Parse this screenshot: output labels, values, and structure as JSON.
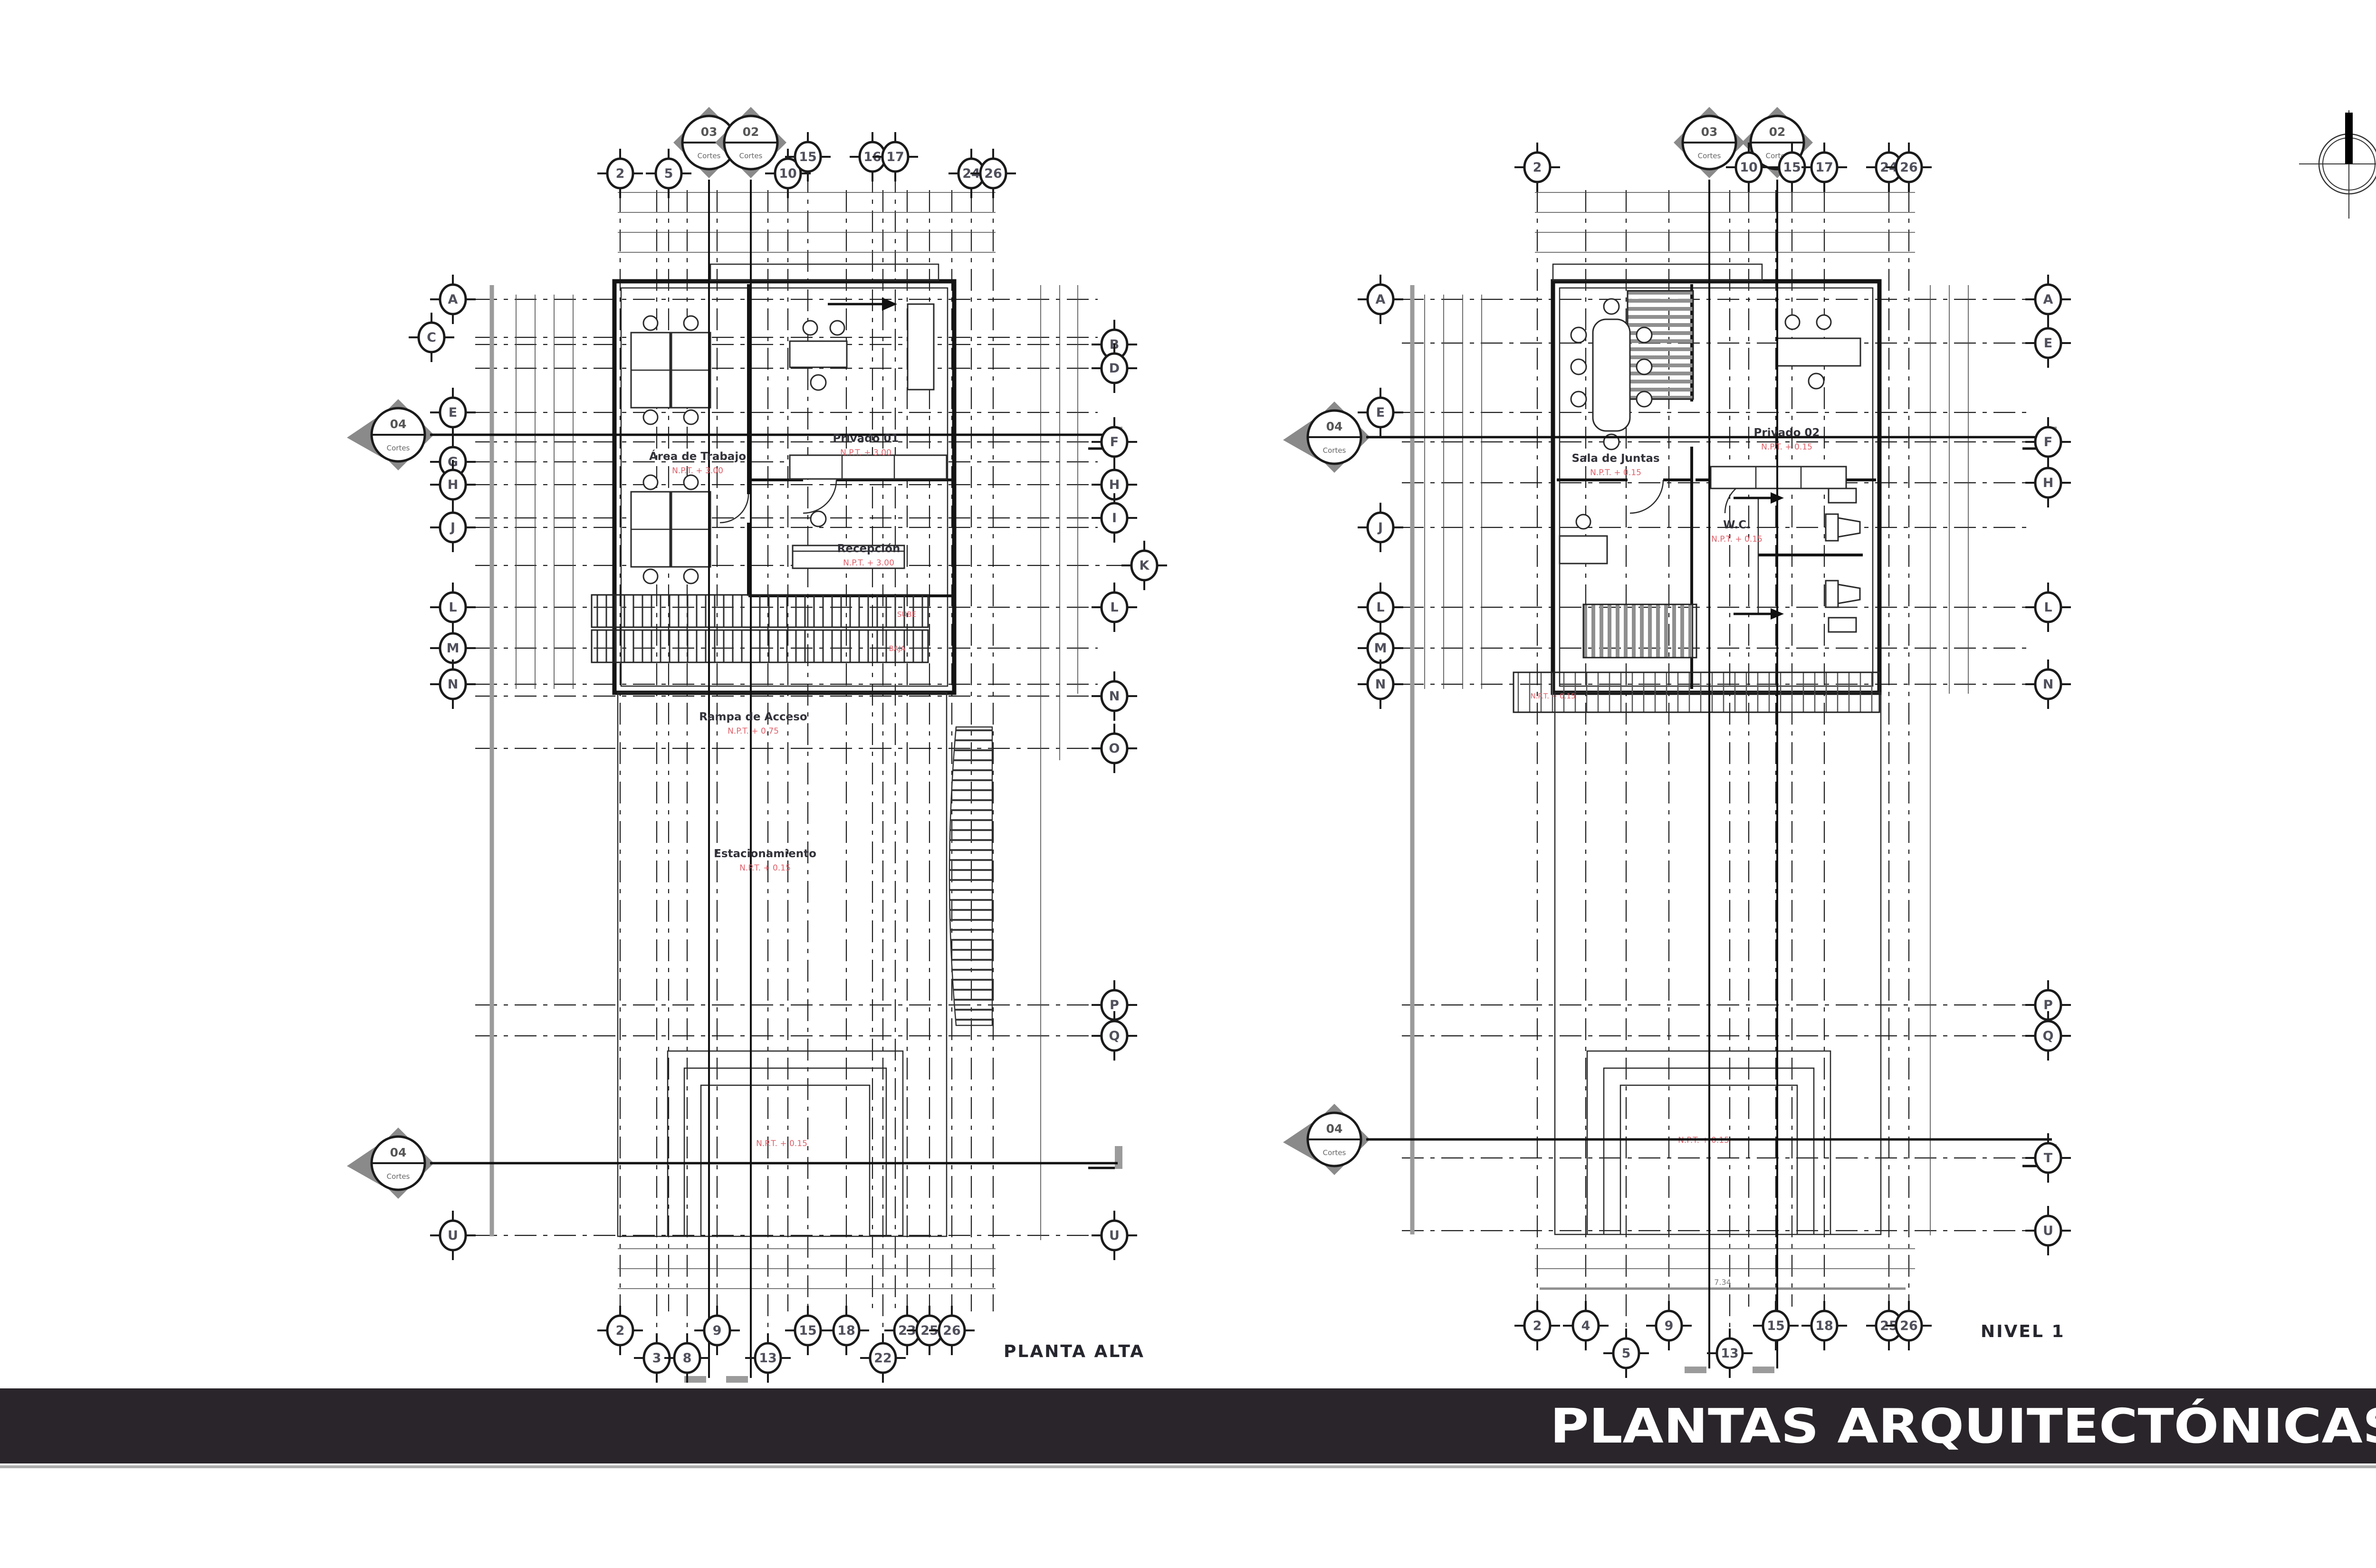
{
  "sheet": {
    "background": "#ffffff"
  },
  "banner": {
    "title": "PLANTAS ARQUITECTÓNICAS",
    "bg": "#29252a",
    "fg": "#ffffff",
    "underline": "#adadad"
  },
  "compass": {
    "meaning": "north-indicator"
  },
  "plans": [
    {
      "title": "PLANTA ALTA",
      "grid_top": [
        "2",
        "5",
        "10",
        "15",
        "16",
        "17",
        "24",
        "26"
      ],
      "grid_bottom": [
        "2",
        "3",
        "8",
        "9",
        "13",
        "15",
        "18",
        "22",
        "23",
        "25",
        "26"
      ],
      "grid_left": [
        "A",
        "C",
        "E",
        "G",
        "H",
        "J",
        "L",
        "M",
        "N",
        "U"
      ],
      "grid_right": [
        "B",
        "D",
        "F",
        "H",
        "I",
        "K",
        "L",
        "N",
        "O",
        "P",
        "Q",
        "U"
      ],
      "section_markers": [
        {
          "num": "03",
          "sub": "Cortes"
        },
        {
          "num": "02",
          "sub": "Cortes"
        }
      ],
      "elevation_markers": [
        {
          "num": "04",
          "sub": "Cortes"
        },
        {
          "num": "04",
          "sub": "Cortes"
        }
      ],
      "rooms": {
        "area": {
          "name": "Área de Trabajo",
          "level": "N.P.T. + 3.00"
        },
        "privado": {
          "name": "Privado 01",
          "level": "N.P.T. + 3.00"
        },
        "recepcion": {
          "name": "Recepción",
          "level": "N.P.T. + 3.00"
        },
        "rampa": {
          "name": "Rampa de Acceso",
          "level": "N.P.T. + 0.75"
        },
        "estacionamiento": {
          "name": "Estacionamiento",
          "level": "N.P.T. + 0.15"
        },
        "patio": {
          "level": "N.P.T. + 0.15"
        }
      },
      "ramp_labels": {
        "up": "SUBE",
        "down": "BAJA"
      }
    },
    {
      "title": "NIVEL 1",
      "grid_top": [
        "2",
        "10",
        "15",
        "17",
        "24",
        "26"
      ],
      "grid_bottom": [
        "2",
        "4",
        "5",
        "9",
        "13",
        "15",
        "18",
        "25",
        "26"
      ],
      "grid_left": [
        "A",
        "E",
        "J",
        "L",
        "M",
        "N"
      ],
      "grid_right": [
        "A",
        "E",
        "F",
        "H",
        "L",
        "N",
        "P",
        "Q",
        "T",
        "U"
      ],
      "section_markers": [
        {
          "num": "03",
          "sub": "Cortes"
        },
        {
          "num": "02",
          "sub": "Cortes"
        }
      ],
      "elevation_markers": [
        {
          "num": "04",
          "sub": "Cortes"
        },
        {
          "num": "04",
          "sub": "Cortes"
        }
      ],
      "rooms": {
        "sala": {
          "name": "Sala de Juntas",
          "level": "N.P.T. + 0.15"
        },
        "privado": {
          "name": "Privado 02",
          "level": "N.P.T. + 0.15"
        },
        "wc": {
          "name": "W.C.",
          "level": "N.P.T. + 0.15"
        },
        "deck": {
          "level": "N.P.T. + 0.15"
        },
        "patio": {
          "level": "N.P.T. + 0.15"
        }
      },
      "dim_label": "7.34"
    }
  ]
}
